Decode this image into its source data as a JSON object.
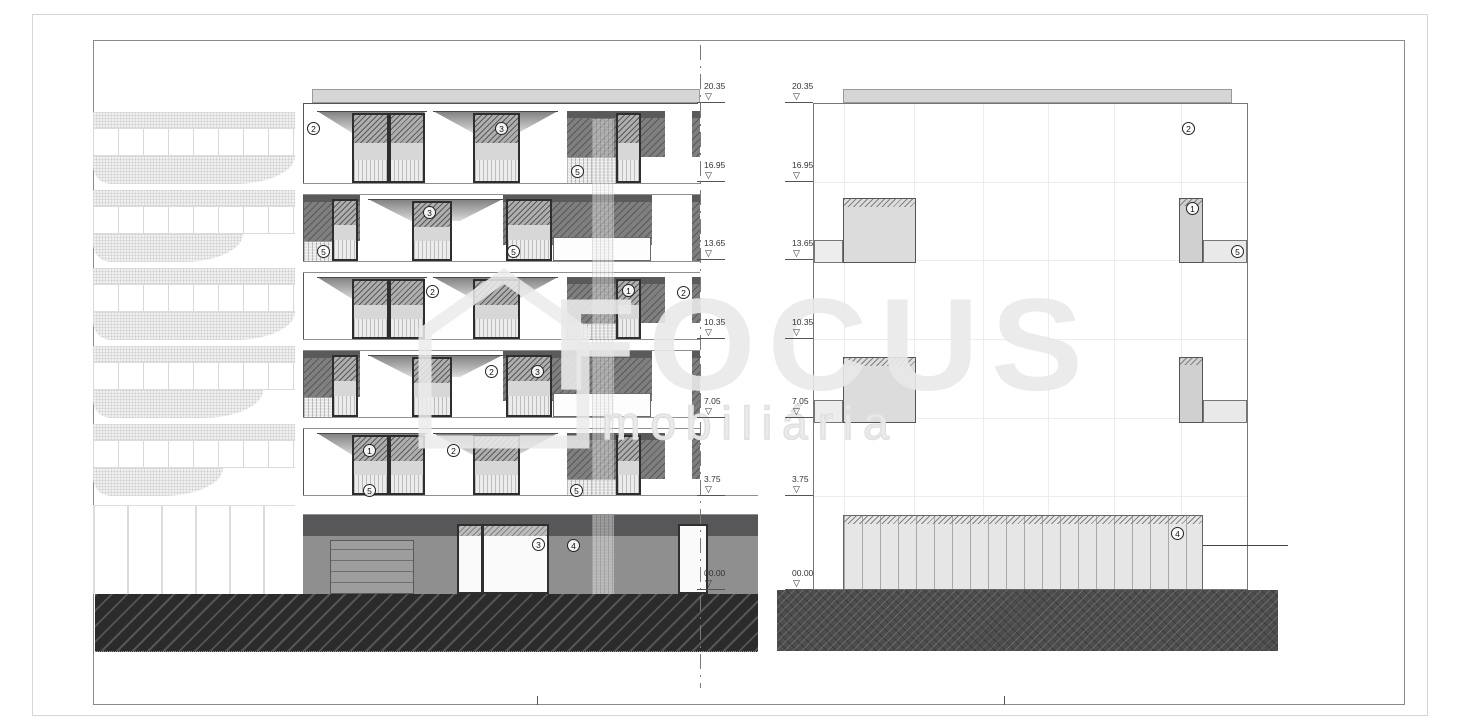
{
  "watermark": {
    "brand": "FOCUS",
    "subtitle": "mobiliária"
  },
  "drawing": {
    "type": "building elevations",
    "views": [
      "front elevation",
      "side elevation"
    ]
  },
  "elevation_levels": [
    {
      "value": "20.35",
      "y": 102
    },
    {
      "value": "16.95",
      "y": 181
    },
    {
      "value": "13.65",
      "y": 259
    },
    {
      "value": "10.35",
      "y": 338
    },
    {
      "value": "7.05",
      "y": 417
    },
    {
      "value": "3.75",
      "y": 495
    },
    {
      "value": "00.00",
      "y": 589
    }
  ],
  "marker_columns_x": [
    697,
    785
  ],
  "annotations": {
    "front_elevation": [
      {
        "label": "2",
        "x": 313,
        "y": 128
      },
      {
        "label": "3",
        "x": 501,
        "y": 128
      },
      {
        "label": "5",
        "x": 577,
        "y": 171
      },
      {
        "label": "5",
        "x": 323,
        "y": 251
      },
      {
        "label": "3",
        "x": 429,
        "y": 212
      },
      {
        "label": "5",
        "x": 513,
        "y": 251
      },
      {
        "label": "2",
        "x": 432,
        "y": 291
      },
      {
        "label": "1",
        "x": 628,
        "y": 290
      },
      {
        "label": "2",
        "x": 683,
        "y": 292
      },
      {
        "label": "2",
        "x": 491,
        "y": 371
      },
      {
        "label": "3",
        "x": 537,
        "y": 371
      },
      {
        "label": "1",
        "x": 369,
        "y": 450
      },
      {
        "label": "2",
        "x": 453,
        "y": 450
      },
      {
        "label": "5",
        "x": 369,
        "y": 490
      },
      {
        "label": "5",
        "x": 576,
        "y": 490
      },
      {
        "label": "3",
        "x": 538,
        "y": 544
      },
      {
        "label": "4",
        "x": 573,
        "y": 545
      }
    ],
    "side_elevation": [
      {
        "label": "2",
        "x": 1188,
        "y": 128
      },
      {
        "label": "1",
        "x": 1192,
        "y": 208
      },
      {
        "label": "5",
        "x": 1237,
        "y": 251
      },
      {
        "label": "4",
        "x": 1177,
        "y": 533
      }
    ]
  },
  "colors": {
    "ground_hatch": "#2b2b2b",
    "facade_gray": "#8f8f8f",
    "parapet_gray": "#d6d6d6",
    "line_dark": "#444444",
    "watermark_gray": "#e9e9e9"
  }
}
